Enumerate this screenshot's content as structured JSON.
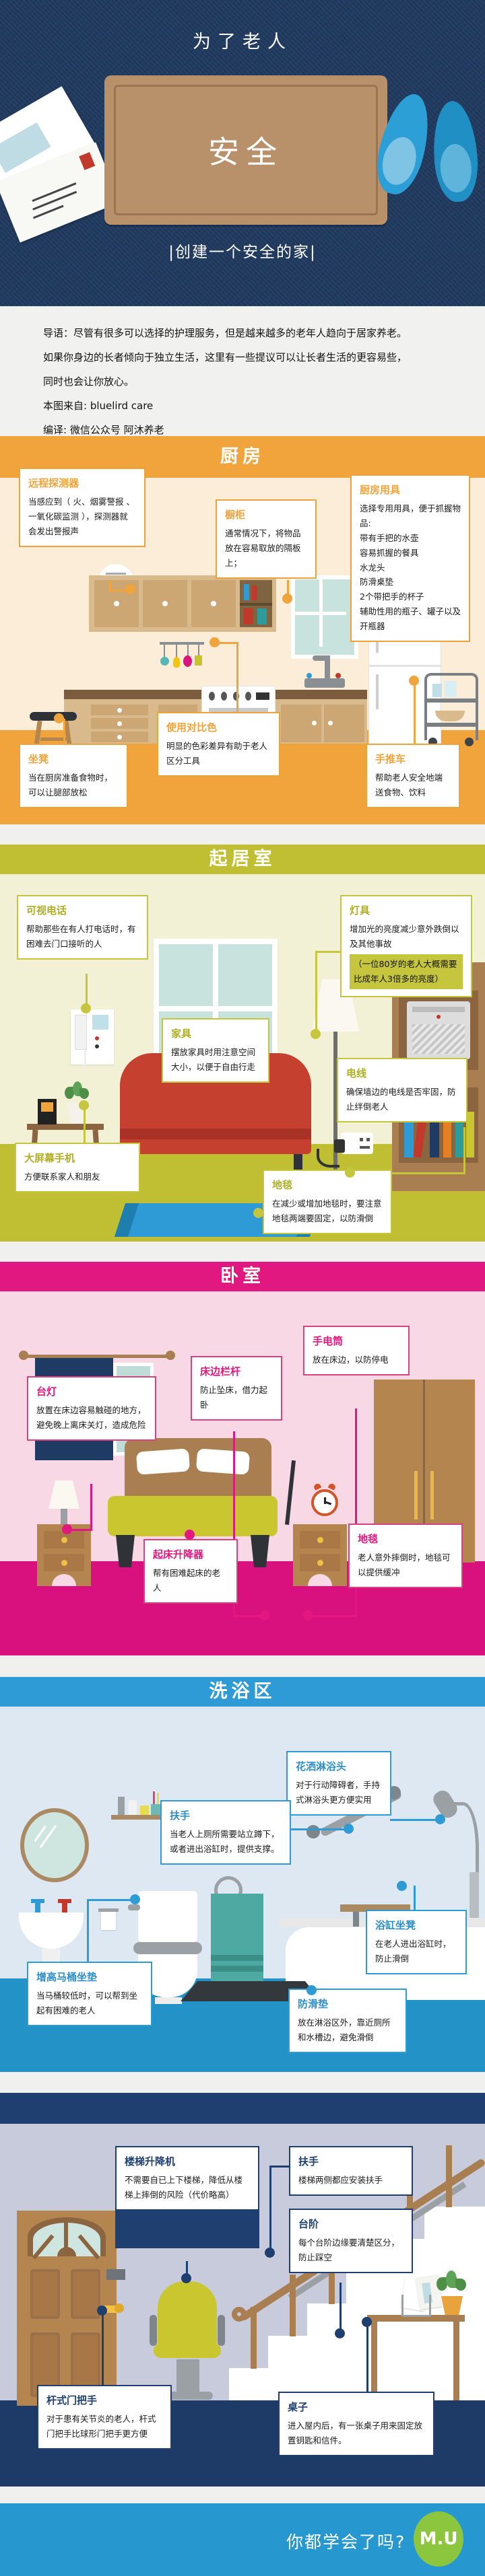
{
  "hero": {
    "title": "为了老人",
    "mat_text": "安全",
    "subtitle": "|创建一个安全的家|"
  },
  "intro": {
    "lines": [
      "导语：尽管有很多可以选择的护理服务，但是越来越多的老年人趋向于居家养老。",
      "如果你身边的长者倾向于独立生活，这里有一些提议可以让长者生活的更容易些，",
      "同时也会让你放心。"
    ],
    "source": "本图来自: bluelird care",
    "editor": "编译: 微信公众号 阿沐养老"
  },
  "kitchen": {
    "title": "厨房",
    "boxes": {
      "detector": {
        "title": "远程探测器",
        "text": "当感应到（ 火、烟雾警报 、一氧化碳监测 ），探测器就会发出警报声"
      },
      "cupboard": {
        "title": "橱柜",
        "text": "通常情况下，将物品放在容易取放的隔板上；"
      },
      "utensils": {
        "title": "厨房用具",
        "lines": [
          "选择专用用具，便于抓握物品:",
          "带有手把的水壶",
          "容易抓握的餐具",
          "水龙头",
          "防滑桌垫",
          "2个带把手的杯子",
          "辅助性用的瓶子、罐子以及",
          "开瓶器"
        ]
      },
      "stool": {
        "title": "坐凳",
        "text": "当在厨房准备食物时，可以让腿部放松"
      },
      "contrast": {
        "title": "使用对比色",
        "text": "明显的色彩差异有助于老人区分工具"
      },
      "cart": {
        "title": "手推车",
        "text": "帮助老人安全地端送食物、饮料"
      }
    }
  },
  "living": {
    "title": "起居室",
    "boxes": {
      "videophone": {
        "title": "可视电话",
        "text": "帮助那些在有人打电话时，有困难去门口接听的人"
      },
      "lamp": {
        "title": "灯具",
        "text": "增加光的亮度减少意外跌倒以及其他事故",
        "highlight": "（一位80岁的老人大概需要比成年人3倍多的亮度）"
      },
      "furniture": {
        "title": "家具",
        "text": "摆放家具时用注意空间大小，以便于自由行走"
      },
      "cords": {
        "title": "电线",
        "text": "确保墙边的电线是否牢固，防止绊倒老人"
      },
      "phone": {
        "title": "大屏幕手机",
        "text": "方便联系家人和朋友"
      },
      "rug": {
        "title": "地毯",
        "text": "在减少或增加地毯时，要注意地毯两端要固定，以防滑倒"
      }
    }
  },
  "bedroom": {
    "title": "卧室",
    "boxes": {
      "lamp": {
        "title": "台灯",
        "text": "放置在床边容易触碰的地方，避免晚上离床关灯，造成危险"
      },
      "rail": {
        "title": "床边栏杆",
        "text": "防止坠床，借力起卧"
      },
      "flashlight": {
        "title": "手电筒",
        "text": "放在床边，以防停电"
      },
      "lift": {
        "title": "起床升降器",
        "text": "帮有困难起床的老人"
      },
      "carpet": {
        "title": "地毯",
        "text": "老人意外摔倒时，地毯可以提供缓冲"
      }
    }
  },
  "bath": {
    "title": "洗浴区",
    "boxes": {
      "shower": {
        "title": "花洒淋浴头",
        "text": "对于行动障碍者，手持式淋浴头更方便实用"
      },
      "grabbar": {
        "title": "扶手",
        "text": "当老人上厕所需要站立蹲下，或者进出浴缸时，提供支撑。"
      },
      "tubseat": {
        "title": "浴缸坐凳",
        "text": "在老人进出浴缸时，防止滑倒"
      },
      "toiletseat": {
        "title": "增高马桶坐垫",
        "text": "当马桶较低时，可以帮到坐起有困难的老人"
      },
      "mat": {
        "title": "防滑垫",
        "text": "放在淋浴区外，靠近厕所和水槽边，避免滑倒"
      }
    }
  },
  "hall": {
    "boxes": {
      "stairlift": {
        "title": "楼梯升降机",
        "text": "不需要自已上下楼梯，降低从楼梯上摔倒的风险（代价略高）"
      },
      "handrail": {
        "title": "扶手",
        "text": "楼梯两侧都应安装扶手"
      },
      "steps": {
        "title": "台阶",
        "text": "每个台阶边缘要清楚区分，防止踩空"
      },
      "doorhandle": {
        "title": "杆式门把手",
        "text": "对于患有关节炎的老人，杆式门把手比球形门把手更方便"
      },
      "table": {
        "title": "桌子",
        "text": "进入屋内后，有一张桌子用来固定放置钥匙和信件。"
      }
    }
  },
  "footer": {
    "question": "你都学会了吗?",
    "logo_text": "M.U"
  },
  "colors": {
    "hero_navy": "#203A5F",
    "kitchen_accent": "#F0A43C",
    "living_accent": "#C0BF33",
    "bedroom_accent": "#DE1380",
    "bath_accent": "#2E9BD6",
    "hall_accent": "#1E3F70",
    "footer_blue": "#2697CF",
    "logo_green": "#8CC63E"
  }
}
